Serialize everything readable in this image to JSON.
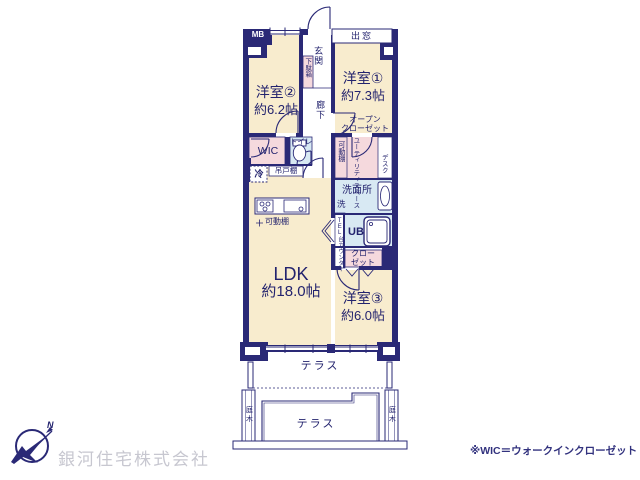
{
  "colors": {
    "wall_navy": "#2a2976",
    "room_cream": "#f8ecce",
    "closet_pink": "#f5d9dd",
    "wet_blue": "#d8e9f3",
    "text_navy": "#23236e",
    "company_gray": "#c7c7d0"
  },
  "plan": {
    "meter_box": "MB",
    "bay_window": "出窓",
    "entrance": "玄関",
    "shoe_cabinet": "下駄箱",
    "hallway": "廊下",
    "rooms": {
      "western1": {
        "name": "洋室①",
        "size": "約7.3帖"
      },
      "western2": {
        "name": "洋室②",
        "size": "約6.2帖"
      },
      "western3": {
        "name": "洋室③",
        "size": "約6.0帖"
      },
      "ldk": {
        "name": "LDK",
        "size": "約18.0帖"
      }
    },
    "open_closet": "オープン\nクローゼット",
    "movable_shelf_vertical": "可動棚",
    "utility_space": "ユーティリティスペース",
    "desk": "デスク",
    "wic": "WIC",
    "toilet": "トイレ",
    "refrigerator": "冷",
    "hanging_cupboard": "吊戸棚",
    "washroom": "洗面所",
    "washer": "洗",
    "movable_shelf_horizontal": "可動棚",
    "tel_stand": "TEL台",
    "counter": "カウンター",
    "unit_bath": "UB",
    "closet": "クロー\nゼット",
    "terrace_upper": "テラス",
    "terrace_lower": "テラス",
    "garden_tree_left": "庭木",
    "garden_tree_right": "庭木"
  },
  "compass": {
    "north_label": "N"
  },
  "footer": {
    "company_name": "銀河住宅株式会社",
    "wic_note": "※WIC＝ウォークインクローゼット"
  }
}
